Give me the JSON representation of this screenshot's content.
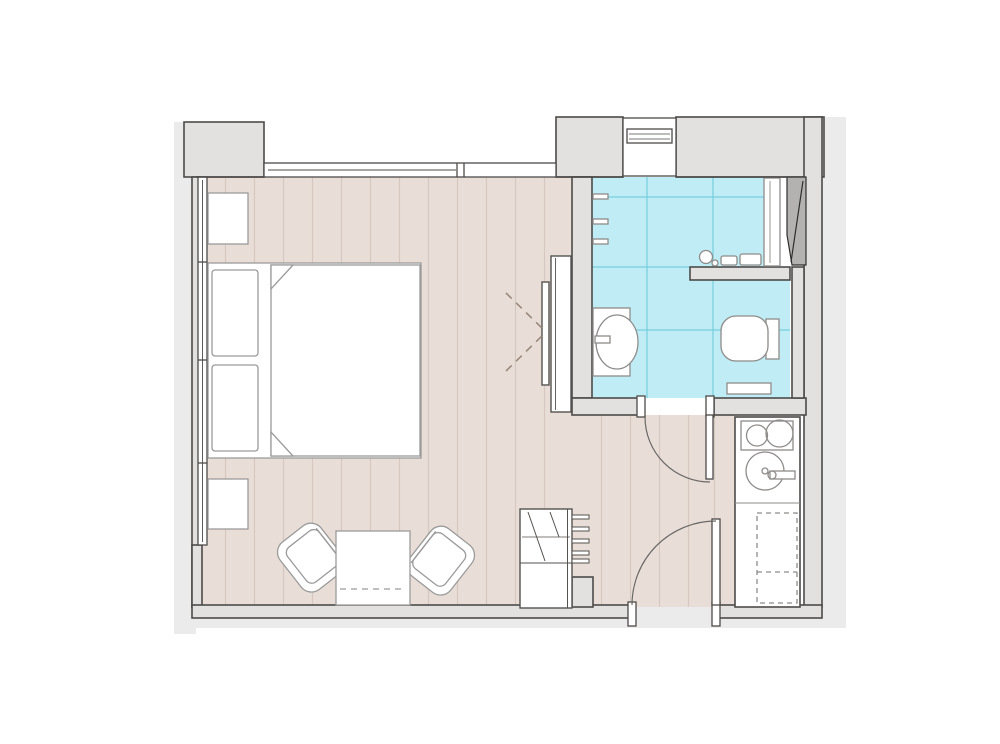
{
  "colors": {
    "background": "#ffffff",
    "shadow": "#ebebeb",
    "wall_fill": "#e3e1e0",
    "wall_line": "#4d4b49",
    "floor_main": "#e8ded7",
    "plank_line": "#d6c8c0",
    "floor_bath": "#c0edf5",
    "tile_line": "#76cfdd",
    "fixture_fill": "#ffffff",
    "fixture_line": "#8e8c8a",
    "furniture_line": "#9a9a9a",
    "cabinet_line": "#55524f",
    "duct_fill": "#b4b2b1",
    "duct_line": "#2e2e2e",
    "door_line": "#6b6865",
    "arrow_dash": "#9a8a7e"
  },
  "plan": {
    "rooms": [
      "bedroom-living-room",
      "bathroom",
      "hallway",
      "kitchenette"
    ],
    "fixtures": [
      "double-bed",
      "nightstand",
      "armchair",
      "side-table",
      "wardrobe",
      "closet",
      "cooktop",
      "kitchen-sink",
      "base-cabinet",
      "washbasin",
      "toilet",
      "shower-shelves",
      "bathroom-shelf",
      "glass-partition",
      "duct",
      "doors",
      "windows"
    ]
  }
}
